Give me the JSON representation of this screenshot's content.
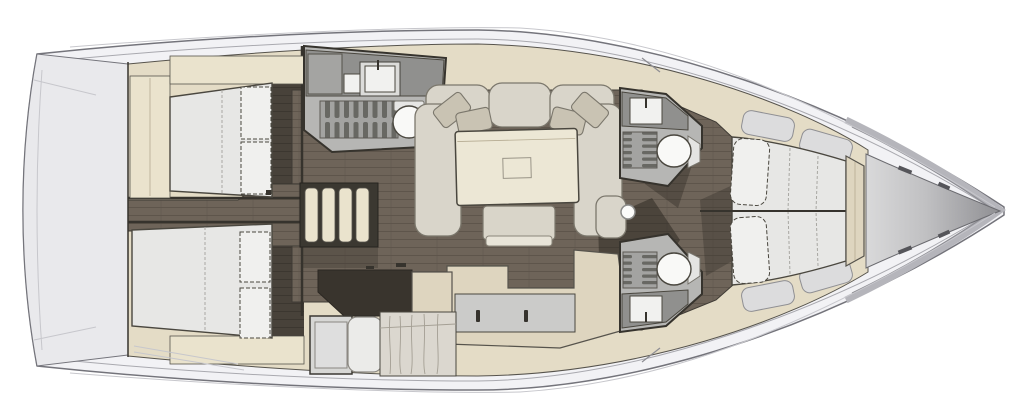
{
  "meta": {
    "type": "yacht-interior-floor-plan",
    "view": "overhead-3d-render",
    "canvas_width": 1024,
    "canvas_height": 420,
    "background": "#ffffff"
  },
  "orientation": {
    "bow": "right",
    "stern": "left",
    "port_side": "top",
    "starboard_side": "bottom"
  },
  "palette": {
    "hullFill": "#f2f2f5",
    "hullLine": "#74747b",
    "sheerLine": "#a9a9af",
    "deckLine": "#c7c7cc",
    "deckFill": "#e9e9ec",
    "toeRail": "#b5b5bb",
    "toeRailLine": "#8d8d93",
    "beigeBase": "#e4dcc6",
    "beige": "#ded5bf",
    "beigeLight": "#eae3cd",
    "floorWood": "#6e6459",
    "floorWoodLine": "#5b5349",
    "floorDark": "#48423a",
    "wallDark": "#36332d",
    "wallMid": "#4a473f",
    "wallThin": "#56534c",
    "mattress": "#e7e7e5",
    "mattressHi": "#f0f0ee",
    "seam": "#a8a7a2",
    "sofa": "#d9d5ca",
    "sofaLine": "#7b776c",
    "pillow": "#c9c3b3",
    "table": "#ece7d5",
    "stool": "#d9d5c9",
    "headFloor": "#b6b6b4",
    "counterDark": "#90908e",
    "counter": "#cbcbc9",
    "grate": "#a3a3a1",
    "grateSlat": "#686863",
    "white": "#f9f9f7",
    "offwhite": "#f1f1ef",
    "duvet": "#dbd7cf",
    "wrinkle": "#a49f94",
    "shadow": "#27231e",
    "shelfGray": "#dcdcdd",
    "shelfLine": "#8f8f93",
    "bowLight": "#d9d9da",
    "bowMid": "#c0c0c2",
    "bowDark": "#8f8f93",
    "mastFill": "#fcfcfa",
    "mastLine": "#8b8b89"
  },
  "vessel": {
    "rooms": [
      {
        "id": "stern-deck",
        "label": "Stern deck and transom"
      },
      {
        "id": "aft-cabin-port",
        "label": "Aft port cabin with double berth and wardrobe"
      },
      {
        "id": "aft-cabin-starboard",
        "label": "Aft starboard cabin with double berth and wardrobe"
      },
      {
        "id": "corridor-aft",
        "label": "Aft corridor between cabins"
      },
      {
        "id": "companionway-steps",
        "label": "Companionway steps with four treads"
      },
      {
        "id": "head-aft-port",
        "label": "Aft port head with shower grating, sink and toilet"
      },
      {
        "id": "saloon",
        "label": "Saloon with U-shaped sofa, four pillows, table and bench"
      },
      {
        "id": "galley",
        "label": "L-shaped galley counter with twin top-opening lockers"
      },
      {
        "id": "mid-berth-starboard",
        "label": "Mid starboard berth with pillow and duvet"
      },
      {
        "id": "head-forward-port",
        "label": "Forward port head with shower grating, sink and toilet"
      },
      {
        "id": "head-forward-starboard",
        "label": "Forward starboard head with shower grating, sink and toilet"
      },
      {
        "id": "forward-cabin",
        "label": "Forward cabin with split V-berth and two pillows"
      },
      {
        "id": "bow-locker",
        "label": "Bow anchor locker"
      },
      {
        "id": "mast-foot",
        "label": "Mast foot on centerline"
      }
    ],
    "fixtures": {
      "toilets": 3,
      "sinks": 3,
      "shower_gratings": 3,
      "berths": 4,
      "saloon_pillows": 4,
      "companionway_treads": 4
    }
  }
}
